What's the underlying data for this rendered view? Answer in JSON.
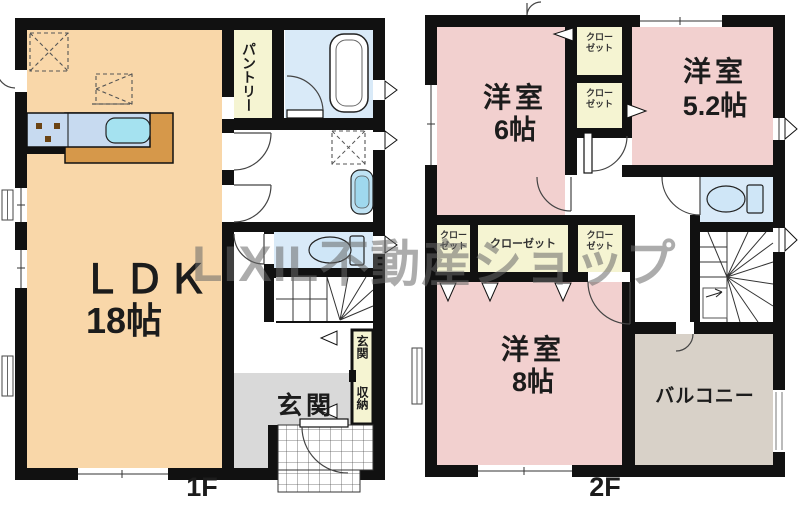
{
  "watermark": "LIXIL不動産ショップ",
  "floor1": {
    "label": "1F",
    "rooms": {
      "ldk": {
        "name": "ＬＤＫ",
        "size": "18帖"
      },
      "pantry": {
        "name": "パントリー"
      },
      "genkan": {
        "name": "玄関"
      },
      "genkan_storage": {
        "line1": "玄関",
        "line2": "収納"
      }
    }
  },
  "floor2": {
    "label": "2F",
    "rooms": {
      "room6": {
        "name": "洋室",
        "size": "6帖"
      },
      "room52": {
        "name": "洋室",
        "size": "5.2帖"
      },
      "room8": {
        "name": "洋室",
        "size": "8帖"
      },
      "balcony": {
        "name": "バルコニー"
      },
      "closet_top1": {
        "line1": "クロー",
        "line2": "ゼット"
      },
      "closet_top2": {
        "line1": "クロー",
        "line2": "ゼット"
      },
      "closet_a": {
        "line1": "クロー",
        "line2": "ゼット"
      },
      "closet_b": {
        "name": "クローゼット"
      },
      "closet_c": {
        "line1": "クロー",
        "line2": "ゼット"
      }
    }
  },
  "colors": {
    "wall": "#111111",
    "ldk_floor": "#f9d7a9",
    "bedroom_pink": "#f2d0cf",
    "wet_area_blue": "#d9eaf8",
    "closet_yellow": "#f5f4d2",
    "entrance_gray": "#d9d9d9",
    "balcony_beige": "#d8d1c8",
    "counter_brown": "#d6984a",
    "sink_cyan": "#a5e2f0",
    "watermark_gray": "#6a6a6a"
  }
}
